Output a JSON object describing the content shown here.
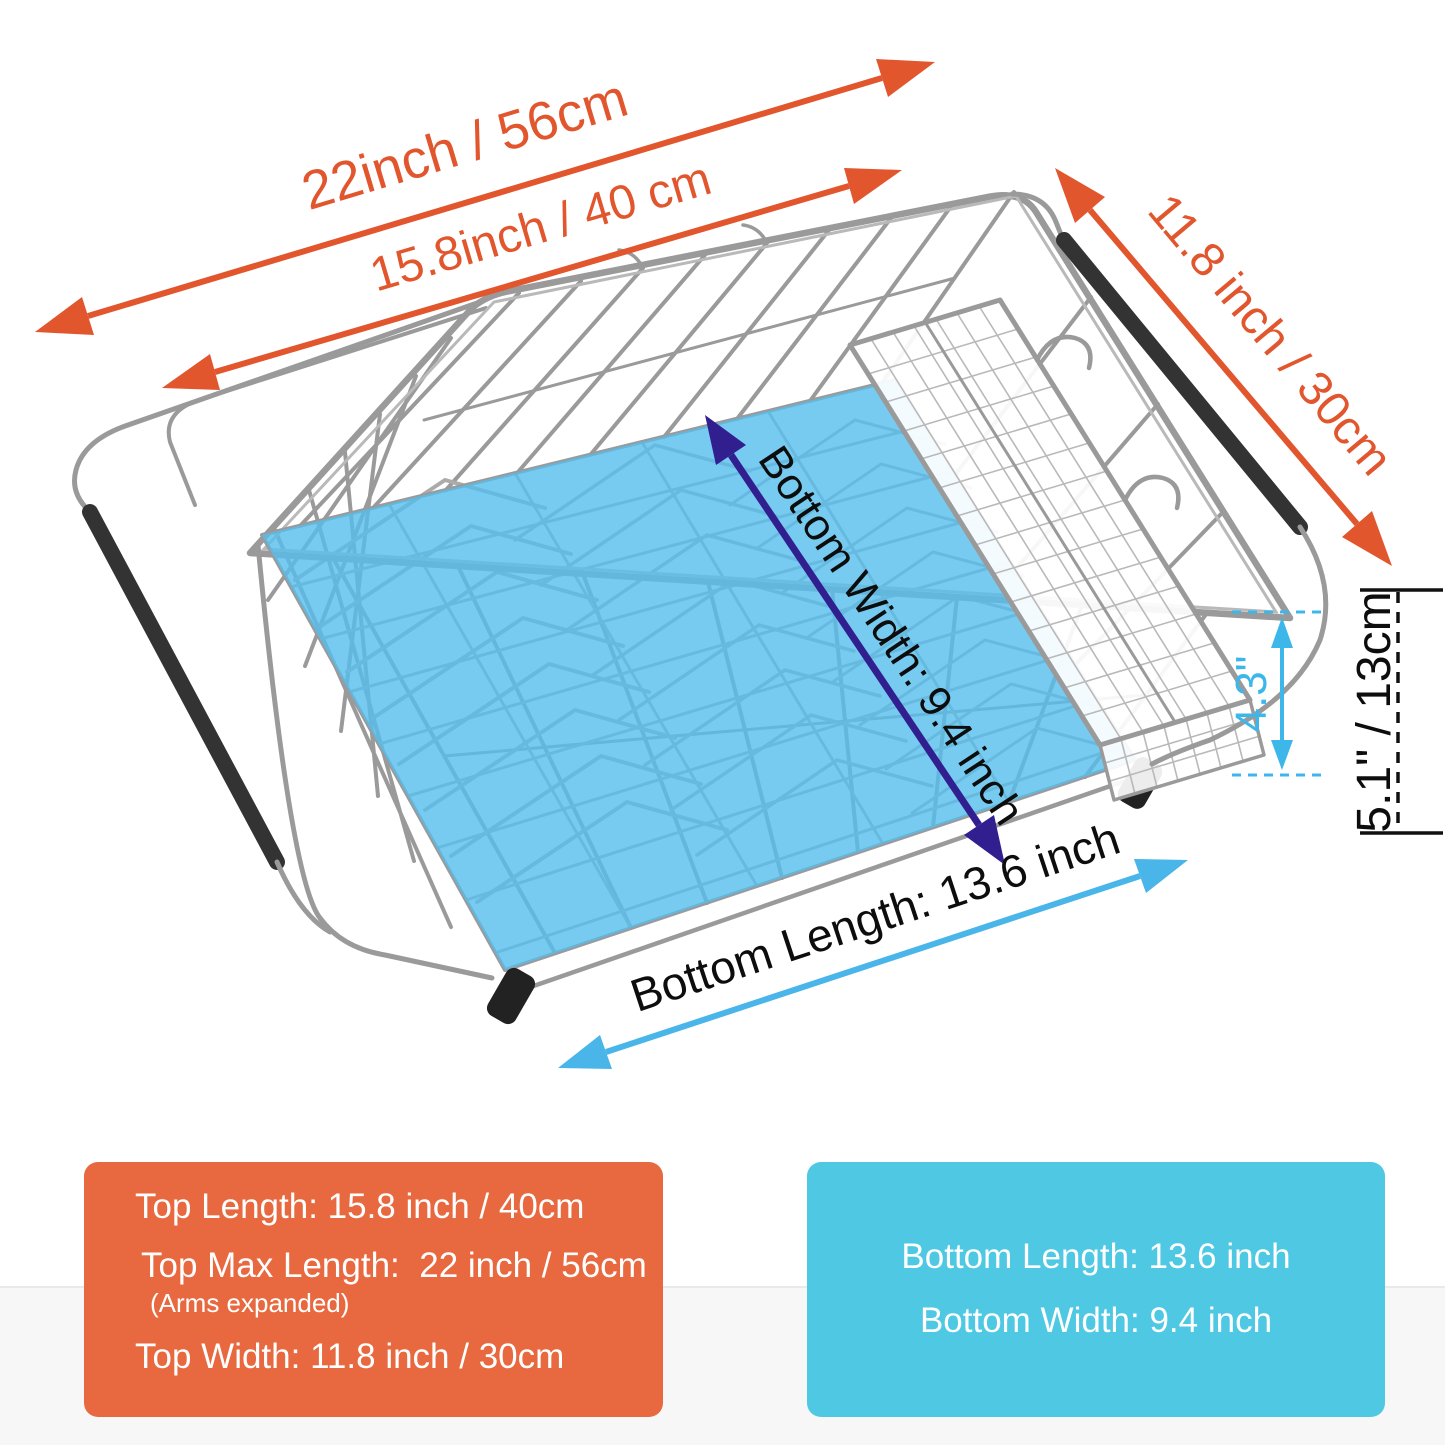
{
  "labels": {
    "top_max_length": "22inch / 56cm",
    "top_length": "15.8inch / 40 cm",
    "top_width": "11.8 inch / 30cm",
    "bottom_width": "Bottom Width: 9.4 inch",
    "bottom_length": "Bottom Length: 13.6 inch",
    "basket_depth": "4.3\"",
    "overall_height": "5.1\" / 13cm"
  },
  "top_box": {
    "top_length": "Top Length: 15.8 inch / 40cm",
    "top_max_length": "Top Max Length:  22 inch / 56cm",
    "top_max_length_note": "(Arms expanded)",
    "top_width": "Top Width: 11.8 inch / 30cm"
  },
  "bottom_box": {
    "bottom_length": "Bottom Length: 13.6 inch",
    "bottom_width": "Bottom Width: 9.4 inch"
  },
  "colors": {
    "dimension_orange": "#E2562E",
    "top_box_orange": "#E8693F",
    "bottom_box_blue": "#4EC8E3",
    "floor_highlight_blue": "#55BEEC",
    "height_annotation_cyan": "#3DB7E9",
    "bottom_length_arrow_blue": "#4AB5E9",
    "bottom_width_arrow_navy": "#311F90",
    "wire_gray": "#9A9A9A"
  }
}
